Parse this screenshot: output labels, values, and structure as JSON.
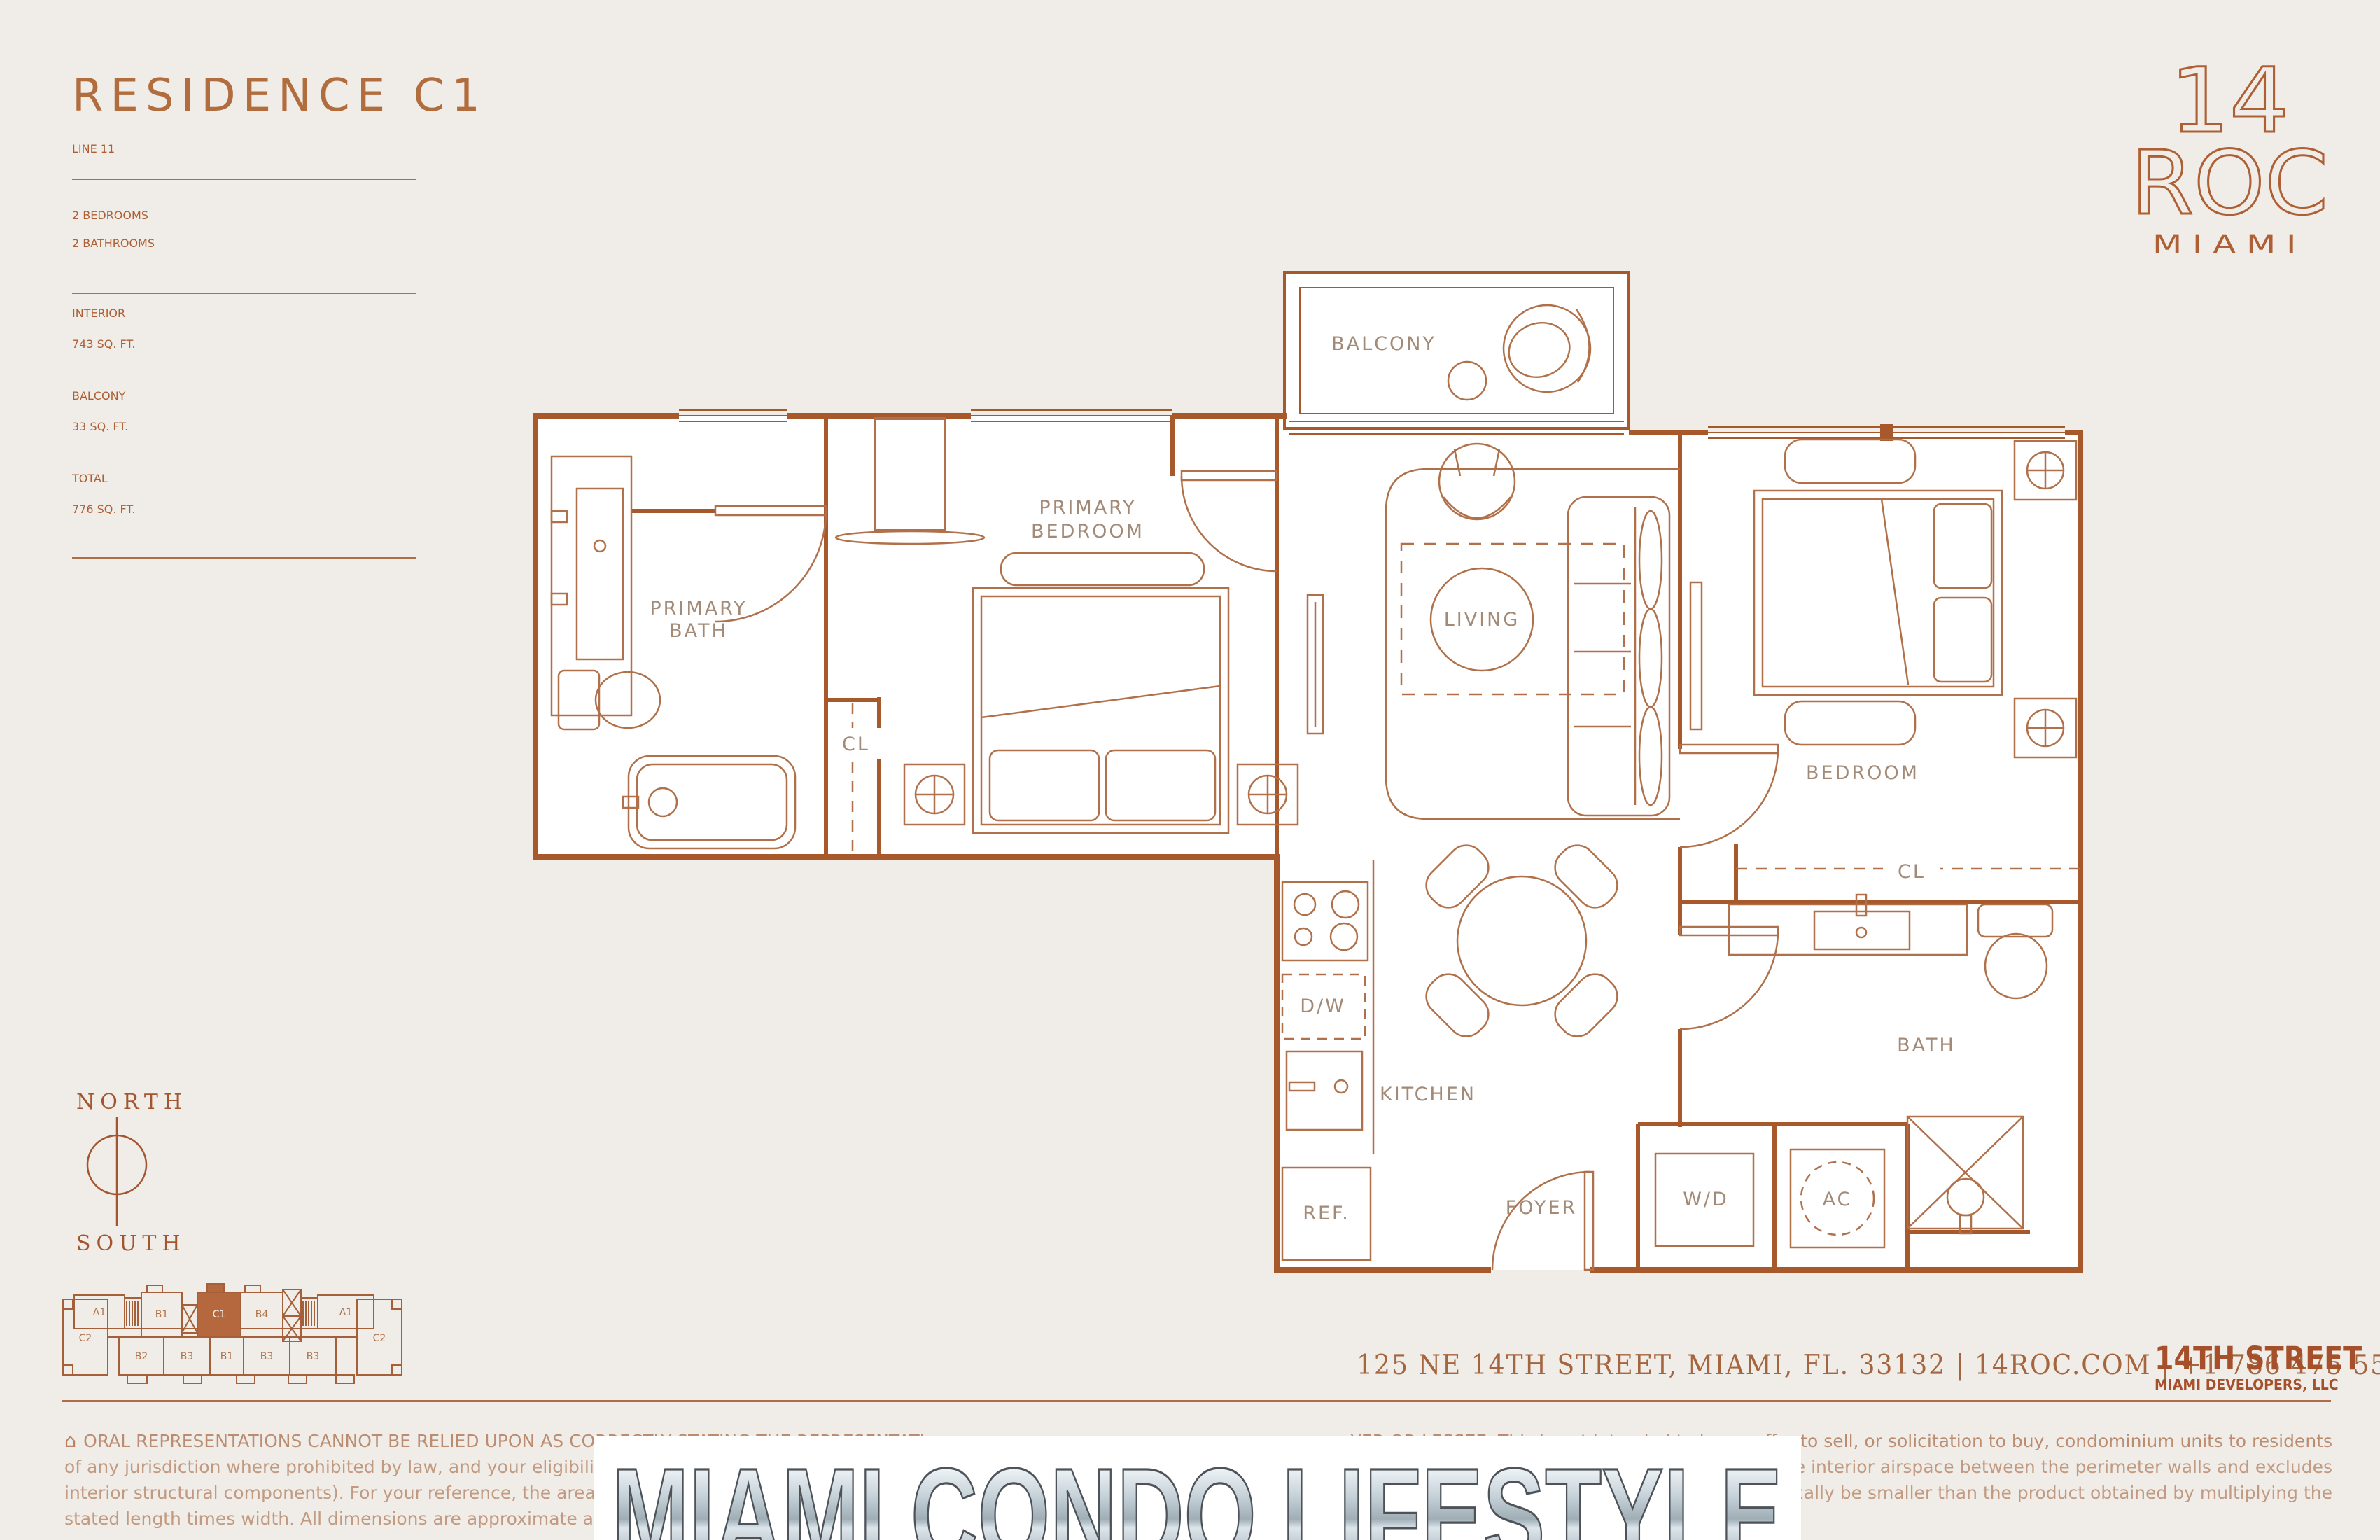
{
  "colors": {
    "background": "#f0ede8",
    "wall_copper": "#a8592c",
    "furniture_copper": "#b0714a",
    "plan_label": "#a28a77",
    "panel_copper": "#ad5f33",
    "value_tan": "#c0a28c",
    "keyplan_highlight": "#b5683d",
    "watermark_outline": "#4d5358"
  },
  "info": {
    "title": "RESIDENCE C1",
    "line_label": "LINE 11",
    "bedrooms": "2 BEDROOMS",
    "bathrooms": "2 BATHROOMS",
    "interior_label": "INTERIOR",
    "interior_value": "743 SQ. FT.",
    "balcony_label": "BALCONY",
    "balcony_value": "33 SQ. FT.",
    "total_label": "TOTAL",
    "total_value": "776 SQ. FT."
  },
  "brand": {
    "line1": "14",
    "line2": "ROC",
    "line3": "MIAMI"
  },
  "plan": {
    "balcony": "BALCONY",
    "primary_bedroom_1": "PRIMARY",
    "primary_bedroom_2": "BEDROOM",
    "primary_bath_1": "PRIMARY",
    "primary_bath_2": "BATH",
    "living": "LIVING",
    "bedroom": "BEDROOM",
    "kitchen": "KITCHEN",
    "bath": "BATH",
    "foyer": "FOYER",
    "dw": "D/W",
    "ref": "REF.",
    "wd": "W/D",
    "ac": "AC",
    "cl_primary": "CL",
    "cl_bedroom": "CL"
  },
  "compass": {
    "north": "NORTH",
    "south": "SOUTH"
  },
  "keyplan": {
    "units": [
      "A1",
      "B1",
      "C1",
      "B4",
      "A1",
      "C2",
      "B2",
      "B3",
      "B1",
      "B3",
      "B3",
      "C2"
    ]
  },
  "footer": {
    "address": "125 NE 14TH STREET, MIAMI, FL. 33132   |   14ROC.COM   |   +1 786 475 5539",
    "developer1": "14TH STREET",
    "developer2": "MIAMI DEVELOPERS, LLC",
    "equal_housing_icon": "⌂",
    "disclaimer": [
      {
        "left": "ORAL REPRESENTATIONS CANNOT BE RELIED UPON AS CORRECTLY STATING THE REPRESENTATI",
        "right": "YER OR LESSEE. This is not intended to be an offer to sell, or solicitation to buy, condominium units to residents"
      },
      {
        "left": "of any jurisdiction where prohibited by law, and your eligibility for purchase will depend upon your state of reside",
        "right": "n the Declaration (which generally only includes the interior airspace between the perimeter walls and excludes"
      },
      {
        "left": "interior structural components). For your reference, the area of the Unit, determined in accordance with those de",
        "right": "uts. Accordingly, the area of the actual room will typically be smaller than the product obtained by multiplying the"
      },
      {
        "left": "stated length times width. All dimensions are approximate and may vary with actual construction, and all floor pl",
        "right": ""
      }
    ]
  },
  "watermark": "MIAMI CONDO LIFESTYLE"
}
